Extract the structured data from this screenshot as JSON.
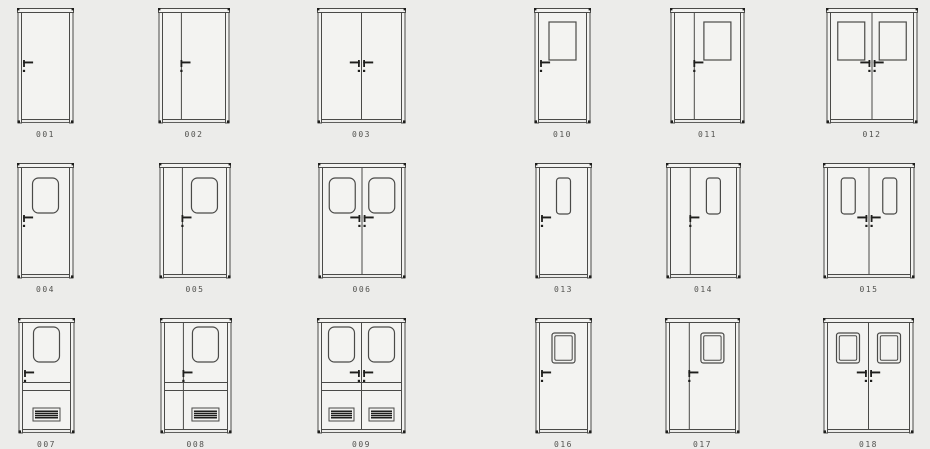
{
  "page": {
    "background": "#ececea",
    "description": "Catalog sheet of 18 door elevation drawings in a 3x6 grid"
  },
  "style": {
    "line_color": "#4a4a48",
    "dark_color": "#1e1e1c",
    "leaf_fill": "#f3f3f1",
    "vent_slit_color": "#d9d9d6",
    "label_color": "#52524f"
  },
  "door_height": 118,
  "window_specs": {
    "rect": {
      "h": 38,
      "top": 14,
      "r": 0,
      "maxw": 27,
      "inner": false
    },
    "rounded": {
      "h": 35,
      "top": 15,
      "r": 6,
      "maxw": 26,
      "inner": false
    },
    "narrow": {
      "h": 36,
      "top": 15,
      "r": 3,
      "maxw": 14,
      "inner": false
    },
    "framed": {
      "h": 30,
      "top": 15,
      "r": 2.5,
      "maxw": 23,
      "inner": true
    }
  },
  "vent_spec": {
    "top": 90,
    "h": 13,
    "maxw": 27,
    "band_y1": 64.5,
    "band_y2": 72.5
  },
  "doors": [
    {
      "label": "001",
      "x": 17,
      "y": 8,
      "w": 57,
      "type": "single",
      "window": "none",
      "vent": false
    },
    {
      "label": "002",
      "x": 158,
      "y": 8,
      "w": 72,
      "type": "unequal",
      "window": "none",
      "vent": false
    },
    {
      "label": "003",
      "x": 317,
      "y": 8,
      "w": 89,
      "type": "double",
      "window": "none",
      "vent": false
    },
    {
      "label": "010",
      "x": 534,
      "y": 8,
      "w": 57,
      "type": "single",
      "window": "rect",
      "vent": false
    },
    {
      "label": "011",
      "x": 670,
      "y": 8,
      "w": 75,
      "type": "unequal",
      "window": "rect",
      "vent": false
    },
    {
      "label": "012",
      "x": 826,
      "y": 8,
      "w": 92,
      "type": "double",
      "window": "rect",
      "vent": false
    },
    {
      "label": "004",
      "x": 17,
      "y": 163,
      "w": 57,
      "type": "single",
      "window": "rounded",
      "vent": false
    },
    {
      "label": "005",
      "x": 159,
      "y": 163,
      "w": 72,
      "type": "unequal",
      "window": "rounded",
      "vent": false
    },
    {
      "label": "006",
      "x": 318,
      "y": 163,
      "w": 88,
      "type": "double",
      "window": "rounded",
      "vent": false
    },
    {
      "label": "013",
      "x": 535,
      "y": 163,
      "w": 57,
      "type": "single",
      "window": "narrow",
      "vent": false
    },
    {
      "label": "014",
      "x": 666,
      "y": 163,
      "w": 75,
      "type": "unequal",
      "window": "narrow",
      "vent": false
    },
    {
      "label": "015",
      "x": 823,
      "y": 163,
      "w": 92,
      "type": "double",
      "window": "narrow",
      "vent": false
    },
    {
      "label": "007",
      "x": 18,
      "y": 318,
      "w": 57,
      "type": "single",
      "window": "rounded",
      "vent": true
    },
    {
      "label": "008",
      "x": 160,
      "y": 318,
      "w": 72,
      "type": "unequal",
      "window": "rounded",
      "vent": true
    },
    {
      "label": "009",
      "x": 317,
      "y": 318,
      "w": 89,
      "type": "double",
      "window": "rounded",
      "vent": true
    },
    {
      "label": "016",
      "x": 535,
      "y": 318,
      "w": 57,
      "type": "single",
      "window": "framed",
      "vent": false
    },
    {
      "label": "017",
      "x": 665,
      "y": 318,
      "w": 75,
      "type": "unequal",
      "window": "framed",
      "vent": false
    },
    {
      "label": "018",
      "x": 823,
      "y": 318,
      "w": 91,
      "type": "double",
      "window": "framed",
      "vent": false
    }
  ]
}
